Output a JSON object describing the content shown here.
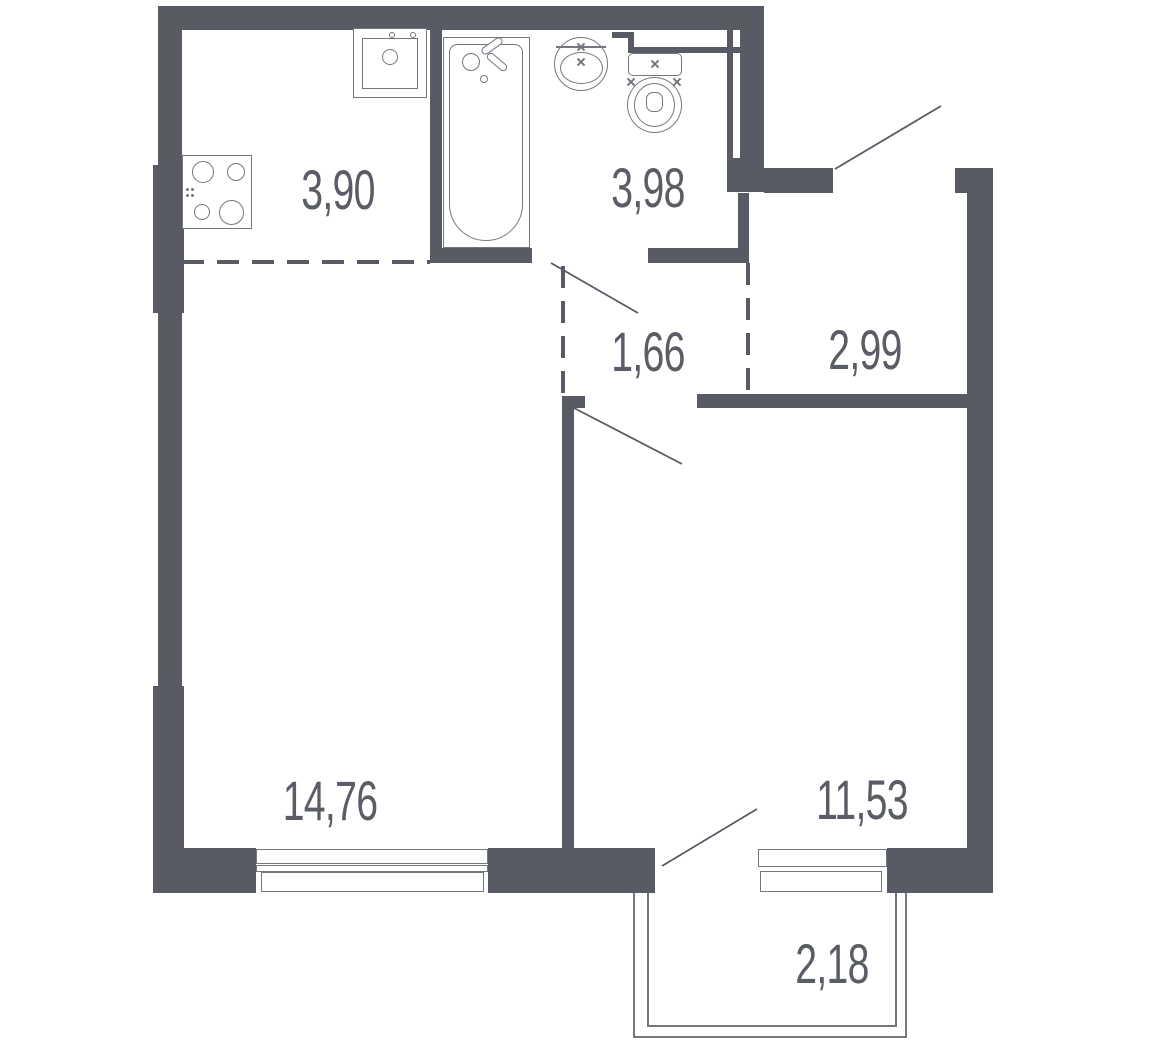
{
  "colors": {
    "wall": "#585B64",
    "line": "#75777F",
    "text": "#5A5D66",
    "balcony": "#75777F"
  },
  "rooms": {
    "kitchen": {
      "area": "3,90"
    },
    "bathroom": {
      "area": "3,98"
    },
    "corridor": {
      "area": "1,66"
    },
    "hallway": {
      "area": "2,99"
    },
    "living_room": {
      "area": "14,76"
    },
    "bedroom": {
      "area": "11,53"
    },
    "balcony": {
      "area": "2,18"
    }
  }
}
